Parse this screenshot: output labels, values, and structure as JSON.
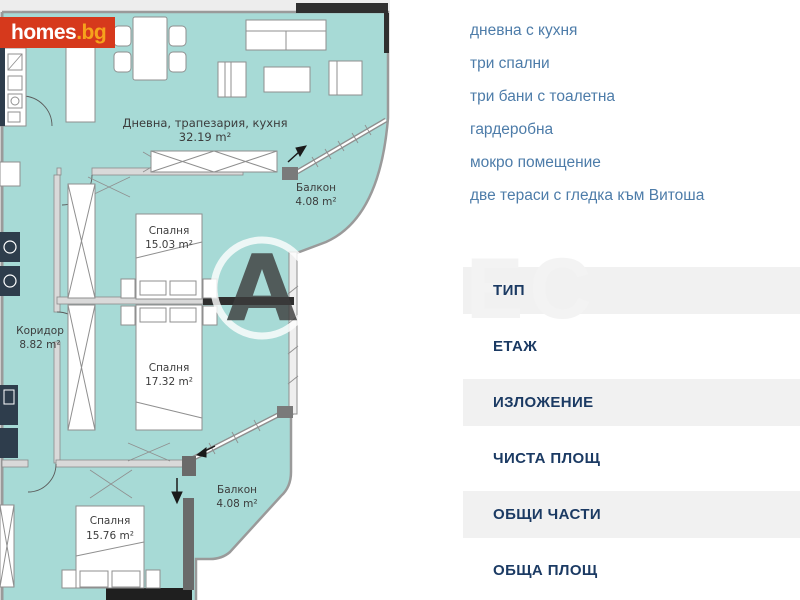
{
  "brand": {
    "logo_main": "homes",
    "logo_suffix": ".bg",
    "logo_bg_color": "#d6391c",
    "logo_suffix_color": "#f6a21c"
  },
  "features": [
    "дневна с кухня",
    "три спални",
    "три бани с тоалетна",
    "гардеробна",
    "мокро помещение",
    "две тераси с гледка към Витоша"
  ],
  "spec_table": {
    "rows": [
      {
        "label": "ТИП"
      },
      {
        "label": "ЕТАЖ"
      },
      {
        "label": "ИЗЛОЖЕНИЕ"
      },
      {
        "label": "ЧИСТА ПЛОЩ"
      },
      {
        "label": "ОБЩИ ЧАСТИ"
      },
      {
        "label": "ОБЩА ПЛОЩ"
      }
    ]
  },
  "floorplan": {
    "rooms": [
      {
        "name": "Дневна, трапезария, кухня",
        "area": "32.19 m²"
      },
      {
        "name": "Балкон",
        "area": "4.08 m²"
      },
      {
        "name": "Спалня",
        "area": "15.03 m²"
      },
      {
        "name": "Коридор",
        "area": "8.82 m²"
      },
      {
        "name": "Спалня",
        "area": "17.32 m²"
      },
      {
        "name": "Балкон",
        "area": "4.08 m²"
      },
      {
        "name": "Спалня",
        "area": "15.76 m²"
      }
    ],
    "watermark": {
      "circle_letter": "A",
      "ghost_letters": "EC"
    },
    "colors": {
      "floor": "#a7dad6",
      "wall": "#8f8f8f",
      "accent_dark": "#2e3d4c"
    }
  }
}
